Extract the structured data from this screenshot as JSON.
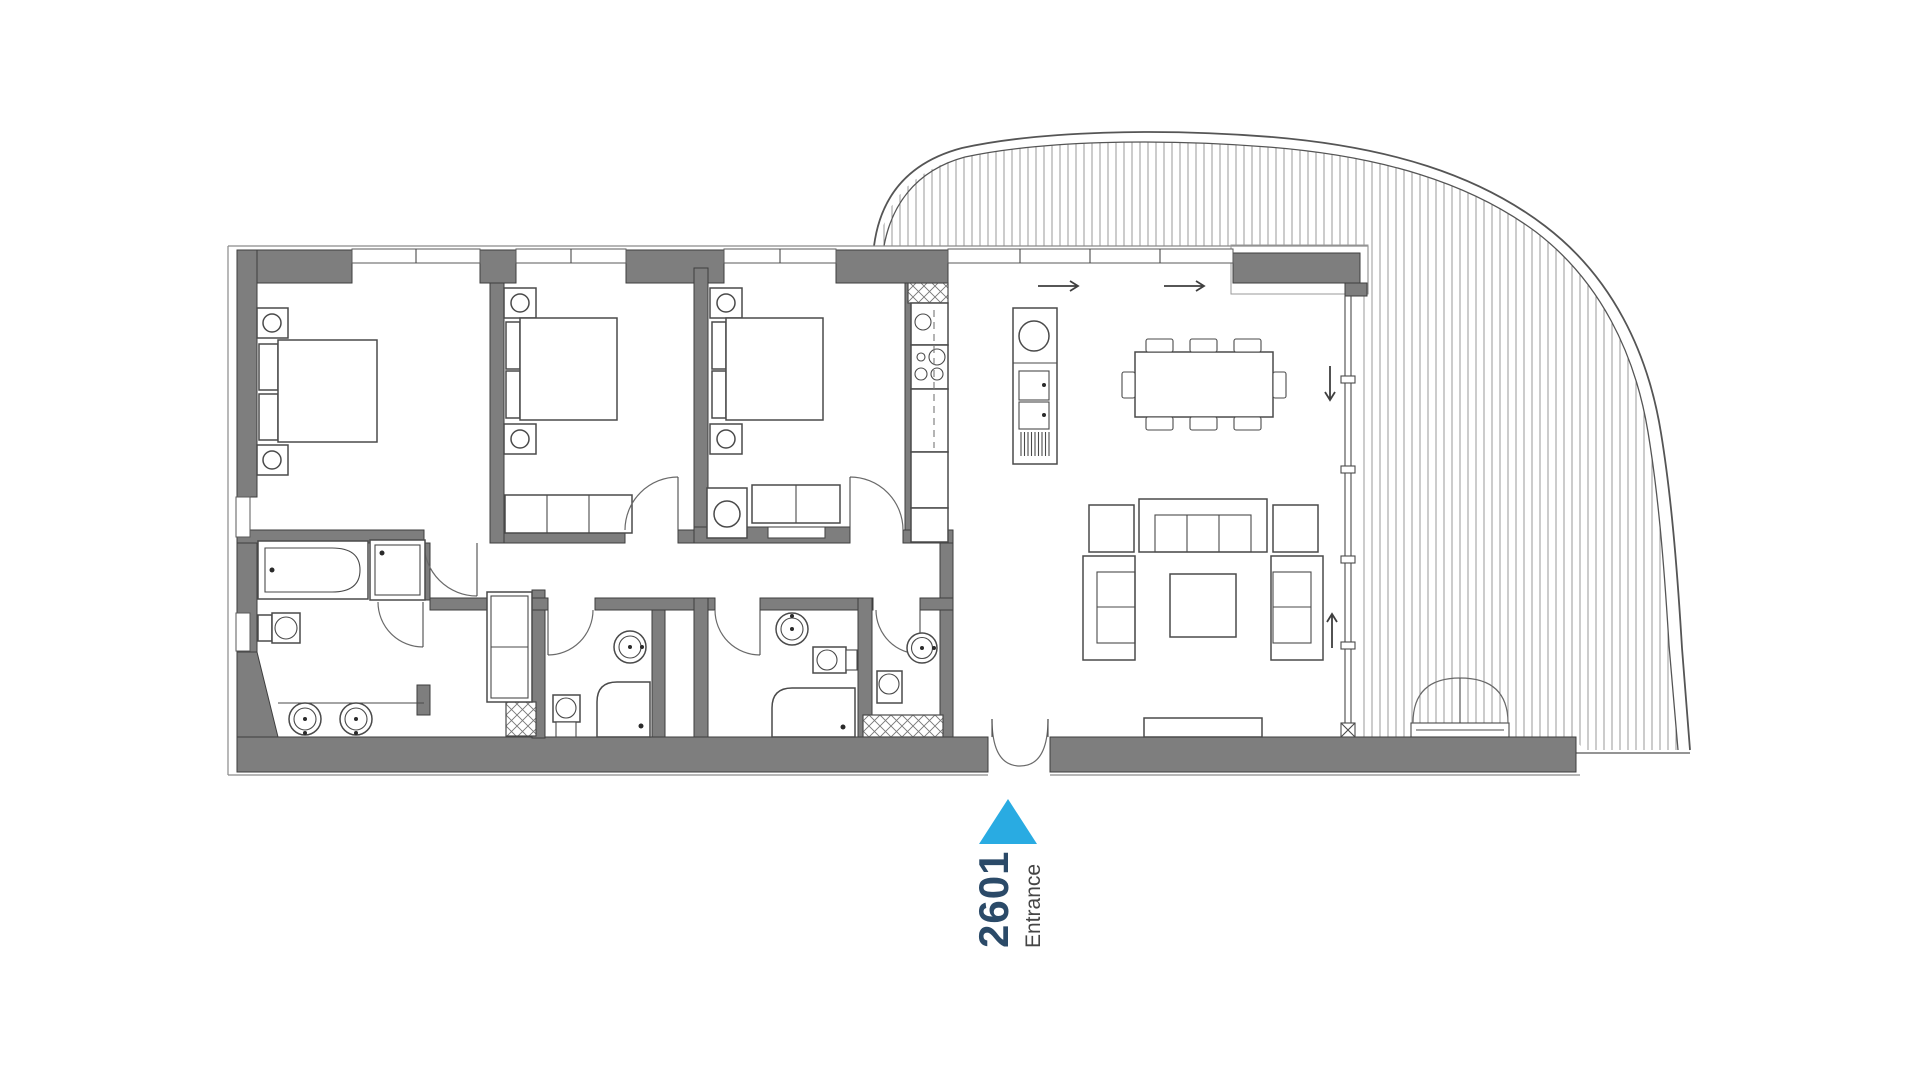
{
  "plan": {
    "unit_number": "2601",
    "entrance_label": "Entrance"
  },
  "colors": {
    "accent_blue": "#29abe2",
    "unit_number_text": "#2b4a68",
    "entrance_text": "#454545",
    "wall_fill": "#7e7e7e",
    "line": "#4a4a4a",
    "hatch": "#9a9a9a",
    "background": "#ffffff"
  }
}
